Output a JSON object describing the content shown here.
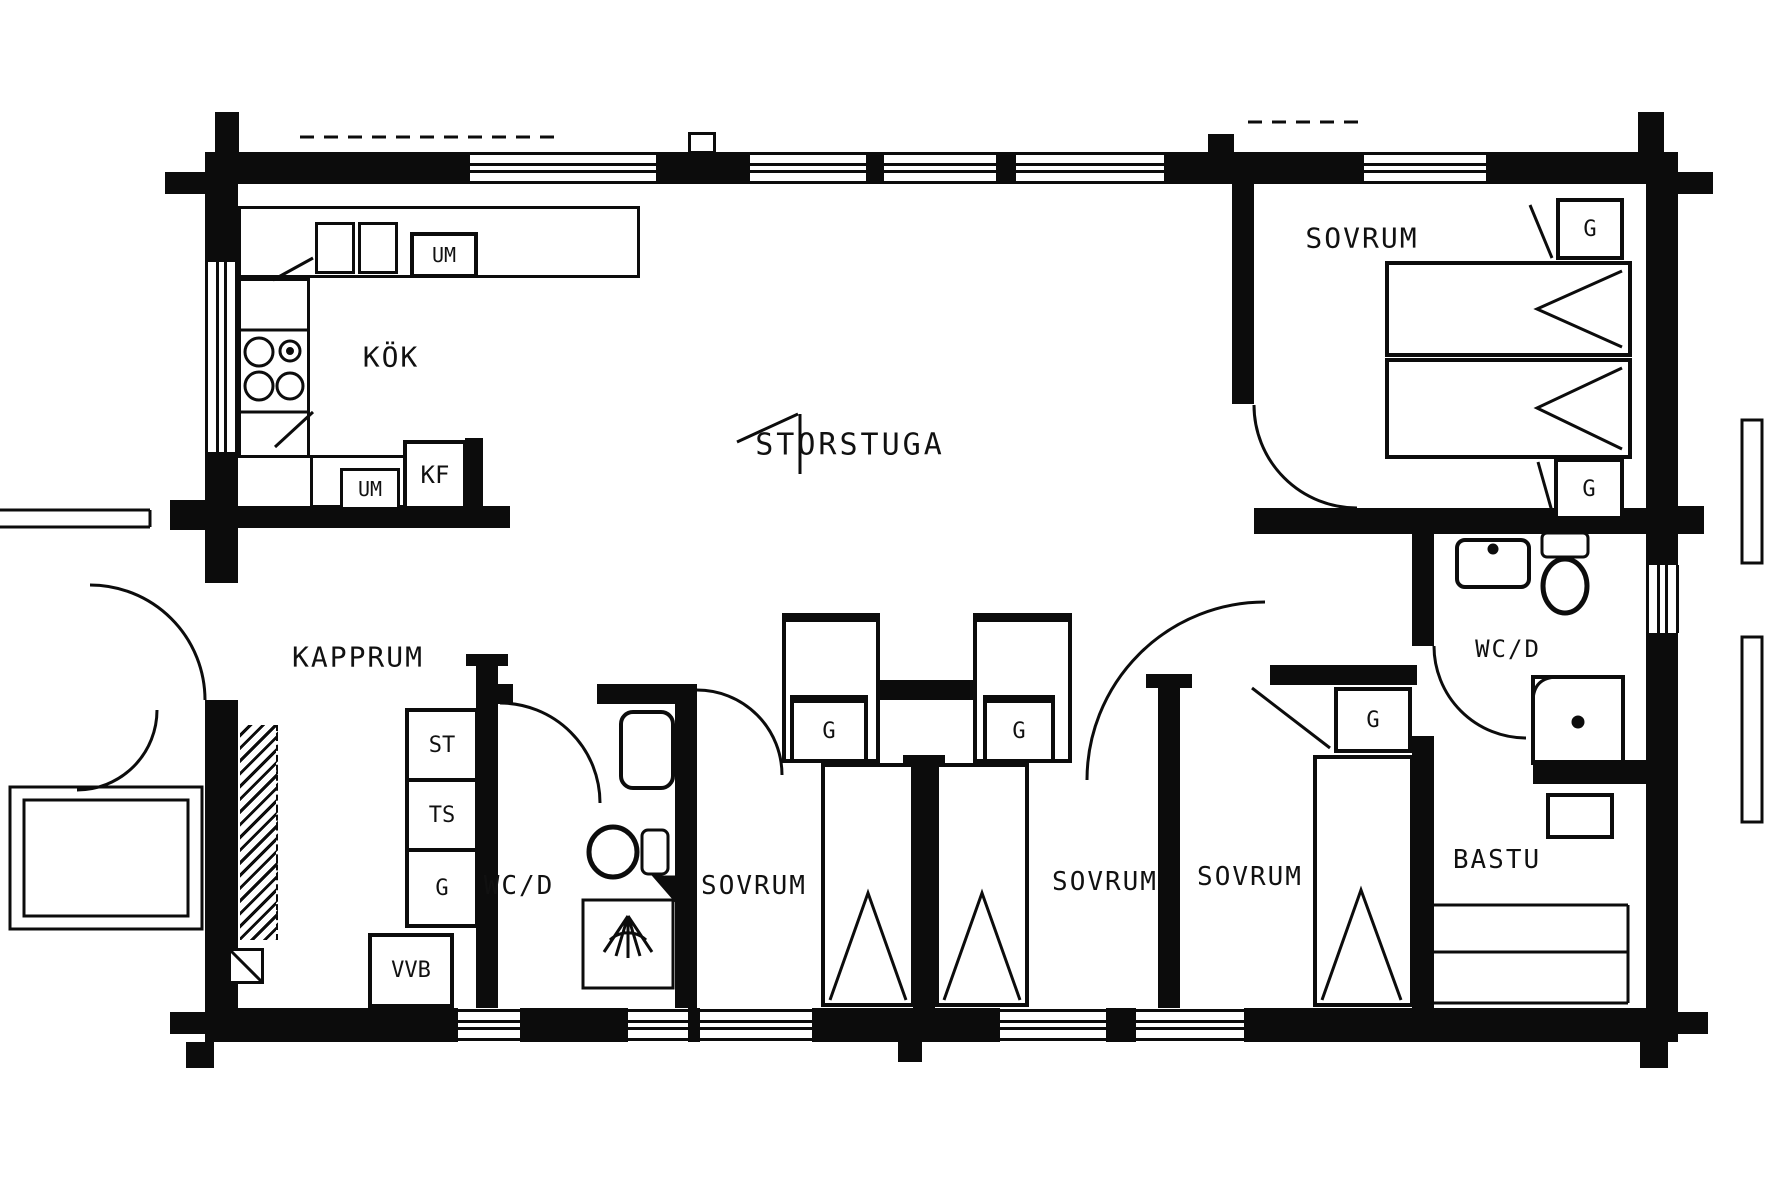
{
  "plan": {
    "type": "cottage-floor-plan",
    "rooms": {
      "kitchen": {
        "label": "KÖK"
      },
      "living": {
        "label": "STORSTUGA"
      },
      "bedroom_ne": {
        "label": "SOVRUM"
      },
      "cloakroom": {
        "label": "KAPPRUM"
      },
      "wc_left": {
        "label": "WC/D"
      },
      "bedroom1": {
        "label": "SOVRUM"
      },
      "bedroom2": {
        "label": "SOVRUM"
      },
      "bedroom3": {
        "label": "SOVRUM"
      },
      "wc_right": {
        "label": "WC/D"
      },
      "sauna": {
        "label": "BASTU"
      }
    },
    "fixtures": {
      "um_top": {
        "label": "UM"
      },
      "um_bottom": {
        "label": "UM"
      },
      "kf": {
        "label": "KF"
      },
      "st": {
        "label": "ST"
      },
      "ts": {
        "label": "TS"
      },
      "g_cloak": {
        "label": "G"
      },
      "vvb": {
        "label": "VVB"
      },
      "g_bed1": {
        "label": "G"
      },
      "g_bed2": {
        "label": "G"
      },
      "g_bed3": {
        "label": "G"
      },
      "g_ne_top": {
        "label": "G"
      },
      "g_ne_bottom": {
        "label": "G"
      }
    },
    "colors": {
      "line": "#0c0c0c",
      "background": "#ffffff"
    }
  }
}
